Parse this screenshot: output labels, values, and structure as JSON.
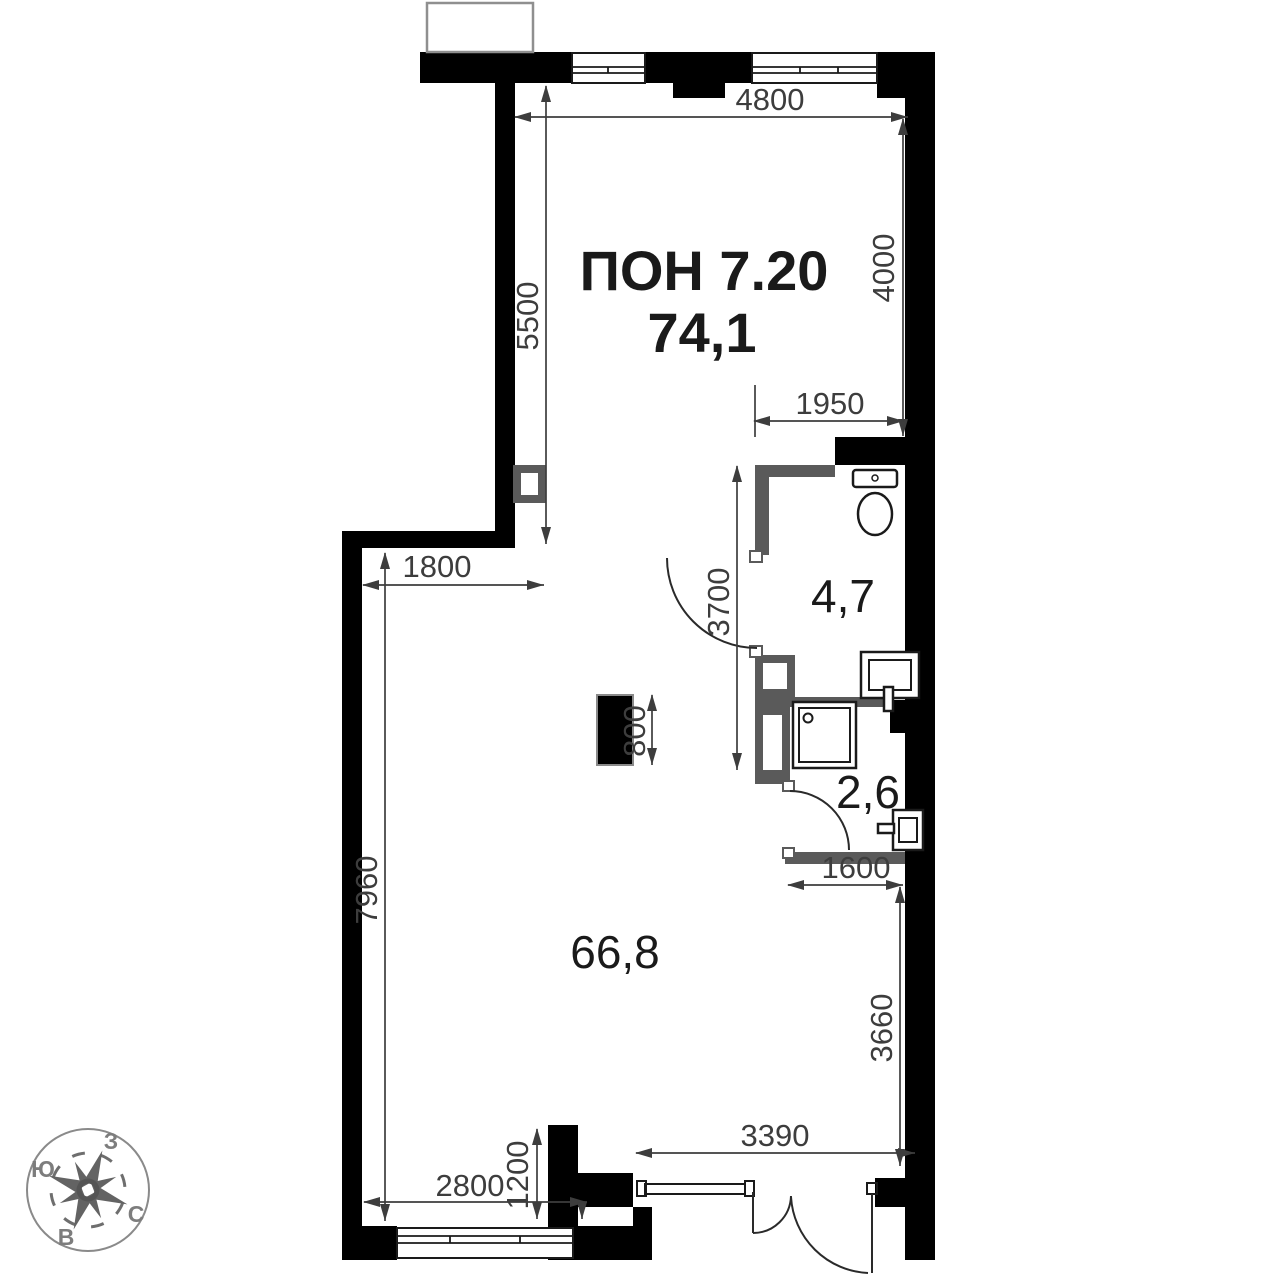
{
  "plan": {
    "unit_label": "ПОН 7.20",
    "total_area": "74,1",
    "rooms": {
      "main_area": "66,8",
      "bathroom_area": "4,7",
      "shower_area": "2,6"
    },
    "dimensions_mm": {
      "top_width": "4800",
      "left_upper_height": "5500",
      "right_upper_height": "4000",
      "wc_width": "1950",
      "wc_height": "3700",
      "column_size": "800",
      "left_offset": "1800",
      "left_lower_height": "7960",
      "shower_width": "1600",
      "right_lower_height": "3660",
      "entry_wall_width": "3390",
      "bottom_window_width": "2800",
      "bottom_niche_depth": "1200"
    },
    "compass": {
      "west": "З",
      "south": "Ю",
      "north": "С",
      "east": "В"
    },
    "colors": {
      "wall": "#000000",
      "partition": "#5a5a5a",
      "dimension": "#3d3d3d",
      "compass": "#6e6e6e"
    }
  }
}
